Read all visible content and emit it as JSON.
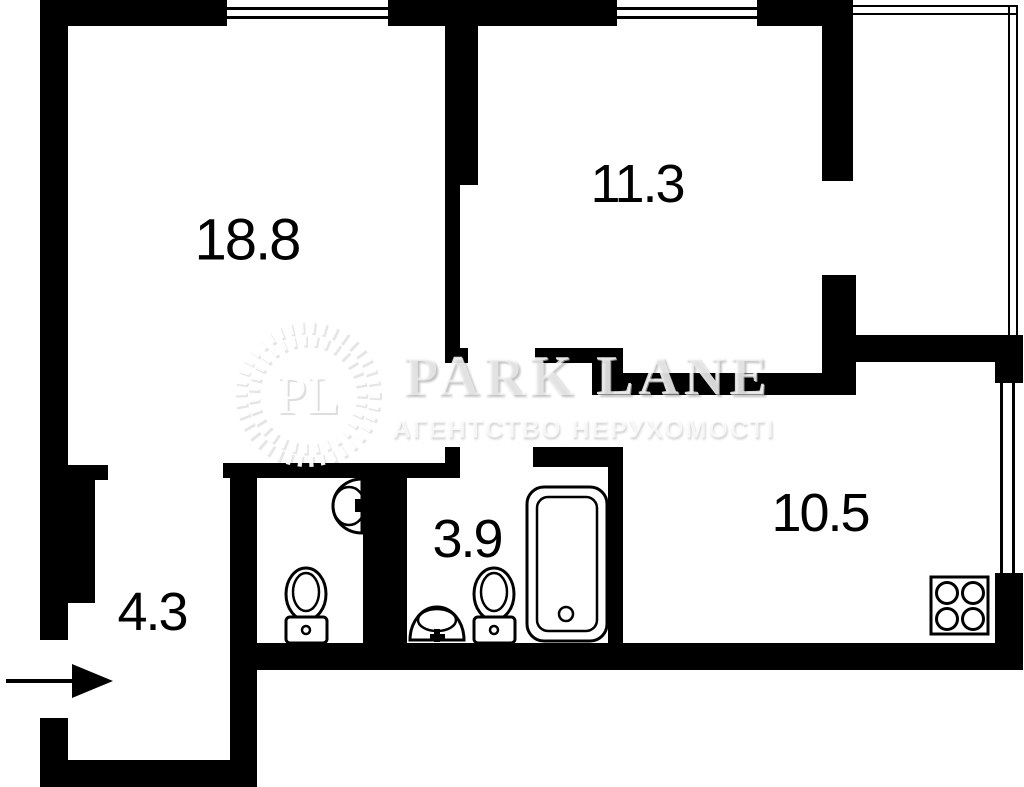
{
  "page": {
    "background_color": "#ffffff",
    "wall_color": "#000000",
    "type_note": "apartment floor plan"
  },
  "watermark": {
    "monogram": "PL",
    "brand": "PARK LANE",
    "tagline": "АГЕНТСТВО НЕРУХОМОСТІ"
  },
  "rooms": [
    {
      "id": "room-18-8",
      "label": "18.8"
    },
    {
      "id": "room-11-3",
      "label": "11.3"
    },
    {
      "id": "room-10-5",
      "label": "10.5"
    },
    {
      "id": "room-4-3",
      "label": "4.3"
    },
    {
      "id": "room-3-9",
      "label": "3.9"
    }
  ],
  "fixtures": [
    {
      "name": "wc-corner-sink"
    },
    {
      "name": "wc-toilet"
    },
    {
      "name": "bathroom-sink"
    },
    {
      "name": "bathroom-toilet"
    },
    {
      "name": "bathtub"
    },
    {
      "name": "stove-4-burner"
    },
    {
      "name": "entrance-arrow",
      "direction": "right"
    }
  ],
  "plan": {
    "walls": [
      [
        40,
        0,
        187,
        26
      ],
      [
        388,
        0,
        229,
        26
      ],
      [
        757,
        0,
        96,
        26
      ],
      [
        40,
        0,
        28,
        640
      ],
      [
        40,
        718,
        28,
        69
      ],
      [
        67,
        480,
        28,
        123
      ],
      [
        40,
        760,
        217,
        27
      ],
      [
        230,
        478,
        27,
        309
      ],
      [
        67,
        465,
        41,
        15
      ],
      [
        223,
        463,
        237,
        15
      ],
      [
        445,
        447,
        15,
        18
      ],
      [
        533,
        447,
        90,
        20
      ],
      [
        363,
        478,
        44,
        165
      ],
      [
        608,
        448,
        15,
        195
      ],
      [
        230,
        643,
        793,
        27
      ],
      [
        995,
        362,
        28,
        21
      ],
      [
        995,
        573,
        28,
        97
      ],
      [
        853,
        335,
        170,
        27
      ],
      [
        822,
        0,
        31,
        181
      ],
      [
        822,
        275,
        34,
        120
      ],
      [
        603,
        373,
        219,
        22
      ],
      [
        535,
        348,
        88,
        15
      ],
      [
        592,
        348,
        31,
        47
      ],
      [
        445,
        0,
        33,
        185
      ],
      [
        445,
        185,
        15,
        178
      ],
      [
        445,
        348,
        23,
        15
      ]
    ],
    "windows": [
      {
        "rect": [
          227,
          0,
          161,
          26
        ],
        "lines": [
          [
            227,
            7,
            161,
            3
          ],
          [
            227,
            16,
            161,
            3
          ]
        ]
      },
      {
        "rect": [
          617,
          0,
          140,
          26
        ],
        "lines": [
          [
            617,
            7,
            140,
            3
          ],
          [
            617,
            16,
            140,
            3
          ]
        ]
      },
      {
        "rect": [
          995,
          383,
          28,
          190
        ],
        "lines": [
          [
            1000,
            383,
            3,
            190
          ],
          [
            1012,
            383,
            3,
            190
          ]
        ]
      }
    ],
    "balcony_glazing": [
      [
        853,
        5,
        165,
        2
      ],
      [
        853,
        13,
        165,
        2
      ],
      [
        1008,
        5,
        2,
        330
      ],
      [
        1016,
        5,
        2,
        330
      ]
    ]
  }
}
